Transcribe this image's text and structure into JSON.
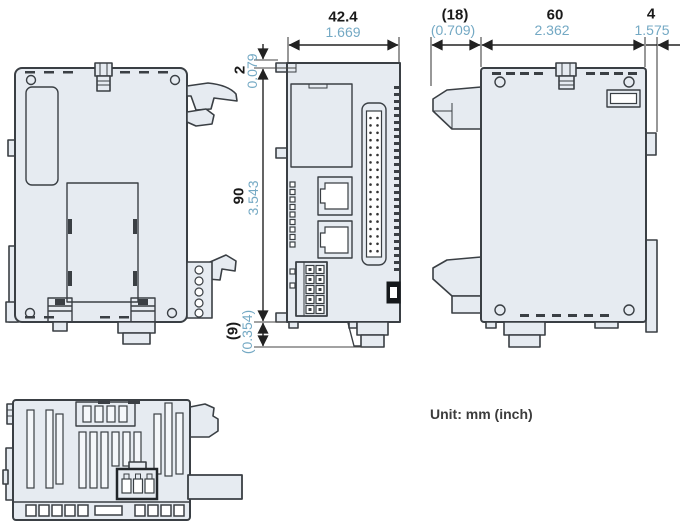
{
  "unit_note": "Unit: mm (inch)",
  "colors": {
    "mm_text": "#1a1a1a",
    "inch_text": "#74a9c4",
    "line": "#333333",
    "body_fill": "#e6ebf1"
  },
  "dimensions": {
    "front_width": {
      "mm": "42.4",
      "inch": "1.669"
    },
    "connector_depth": {
      "mm": "(18)",
      "inch": "(0.709)"
    },
    "body_depth": {
      "mm": "60",
      "inch": "2.362"
    },
    "rail_clip_depth": {
      "mm": "4",
      "inch": "1.575"
    },
    "top_step_height": {
      "mm": "2",
      "inch": "0.079"
    },
    "body_height": {
      "mm": "90",
      "inch": "3.543"
    },
    "foot_height": {
      "mm": "(9)",
      "inch": "(0.354)"
    }
  }
}
